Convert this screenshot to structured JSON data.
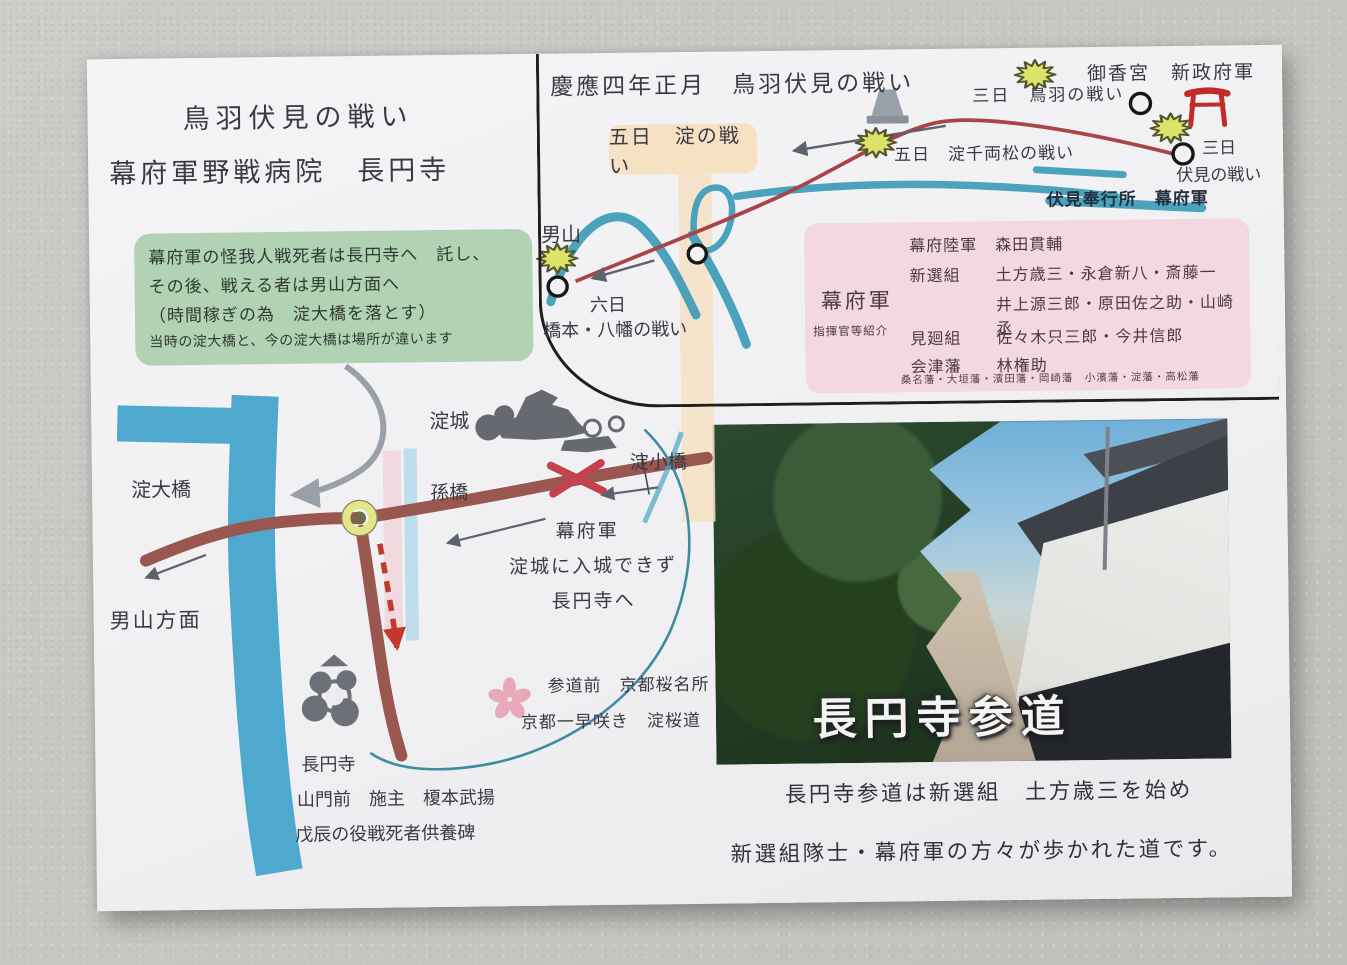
{
  "card": {
    "header": {
      "title": "鳥羽伏見の戦い",
      "subtitle": "幕府軍野戦病院　長円寺"
    },
    "note_box": {
      "line1": "幕府軍の怪我人戦死者は長円寺へ　託し、",
      "line2": "その後、戦える者は男山方面へ",
      "line3": "（時間稼ぎの為　淀大橋を落とす）",
      "line4": "当時の淀大橋と、今の淀大橋は場所が違います"
    },
    "battle_map": {
      "title": "慶應四年正月　鳥羽伏見の戦い",
      "yodo_battle_badge": "五日　淀の戦い",
      "gokonomiya": "御香宮　新政府軍",
      "toba_battle": "三日　鳥羽の戦い",
      "senryomatsu_battle": "五日　淀千両松の戦い",
      "fushimi_day": "三日",
      "fushimi_battle": "伏見の戦い",
      "fushimi_bugyosho": "伏見奉行所　幕府軍",
      "otokoyama": "男山",
      "muika": "六日",
      "hashimoto_battle": "橋本・八幡の戦い",
      "icons": [
        "battle-burst",
        "battle-site-circle",
        "monument",
        "torii-gate"
      ]
    },
    "commanders_box": {
      "army": "幕府軍",
      "caption": "指揮官等紹介",
      "rows": [
        {
          "group": "幕府陸軍",
          "names": "森田貫輔"
        },
        {
          "group": "新選組",
          "names": "土方歳三・永倉新八・斎藤一"
        },
        {
          "group": "",
          "names": "井上源三郎・原田佐之助・山崎丞"
        },
        {
          "group": "見廻組",
          "names": "佐々木只三郎・今井信郎"
        },
        {
          "group": "会津藩",
          "names": "林権助"
        }
      ],
      "footnote": "桑名藩・大垣藩・濱田藩・岡崎藩　小濱藩・淀藩・高松藩"
    },
    "town_map": {
      "yodo_castle": "淀城",
      "yodo_kobashi": "淀小橋",
      "magobashi": "孫橋",
      "yodo_ohashi": "淀大橋",
      "otokoyama_direction": "男山方面",
      "route_note": {
        "line1": "幕府軍",
        "line2": "淀城に入城できず",
        "line3": "長円寺へ"
      },
      "sakura_note": {
        "line1": "参道前　京都桜名所",
        "line2": "京都一早咲き　淀桜道"
      },
      "choenji_note": {
        "line1": "長円寺",
        "line2": "山門前　施主　榎本武揚",
        "line3": "戊辰の役戦死者供養碑"
      },
      "icons": [
        "castle-stamp",
        "temple-stamp",
        "cherry-blossom",
        "roundabout",
        "destroyed-bridge-x",
        "retreat-arrows"
      ]
    },
    "photo": {
      "caption": "長円寺参道"
    },
    "footer": {
      "line1": "長円寺参道は新選組　土方歳三を始め",
      "line2": "新選組隊士・幕府軍の方々が歩かれた道です。"
    },
    "colors": {
      "river_blue": "#4fa9cf",
      "river_teal": "#3d9cb8",
      "route_red": "#a94449",
      "road_brown": "#9a574f",
      "note_green": "#b2d2b4",
      "badge_peach": "#f6e1c3",
      "commanders_pink": "#f3d7e1",
      "burst_yellow": "#dce36a",
      "torii_red": "#c32a2a",
      "ink": "#3a3a44"
    }
  }
}
